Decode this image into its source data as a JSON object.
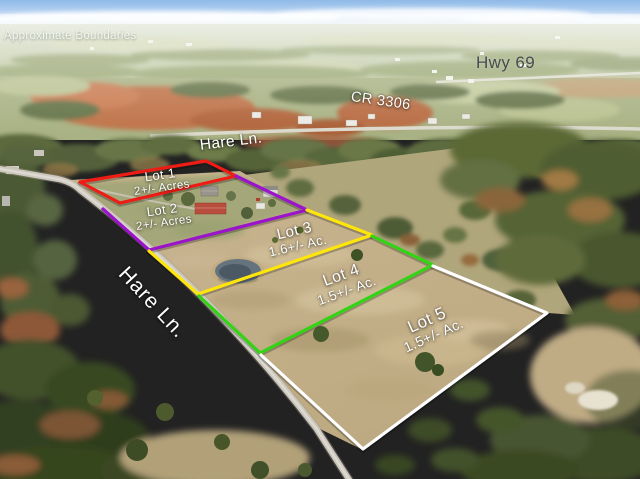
{
  "photo": {
    "watermark": "Approximate Boundaries"
  },
  "roads": {
    "hwy69_label": "Hwy 69",
    "cr3306_label": "CR 3306",
    "hare_lane_top_label": "Hare Ln.",
    "hare_lane_road_label": "Hare Ln."
  },
  "lots": [
    {
      "name": "Lot 1",
      "acreage": "2+/- Acres",
      "boundary_color": "#ee1c15"
    },
    {
      "name": "Lot 2",
      "acreage": "2+/- Acres",
      "boundary_color": "#9b14cb"
    },
    {
      "name": "Lot 3",
      "acreage": "1.6+/- Ac.",
      "boundary_color": "#ffe60a"
    },
    {
      "name": "Lot 4",
      "acreage": "1.5+/- Ac.",
      "boundary_color": "#33d414"
    },
    {
      "name": "Lot 5",
      "acreage": "1.5+/- Ac.",
      "boundary_color": "#ffffff"
    }
  ]
}
